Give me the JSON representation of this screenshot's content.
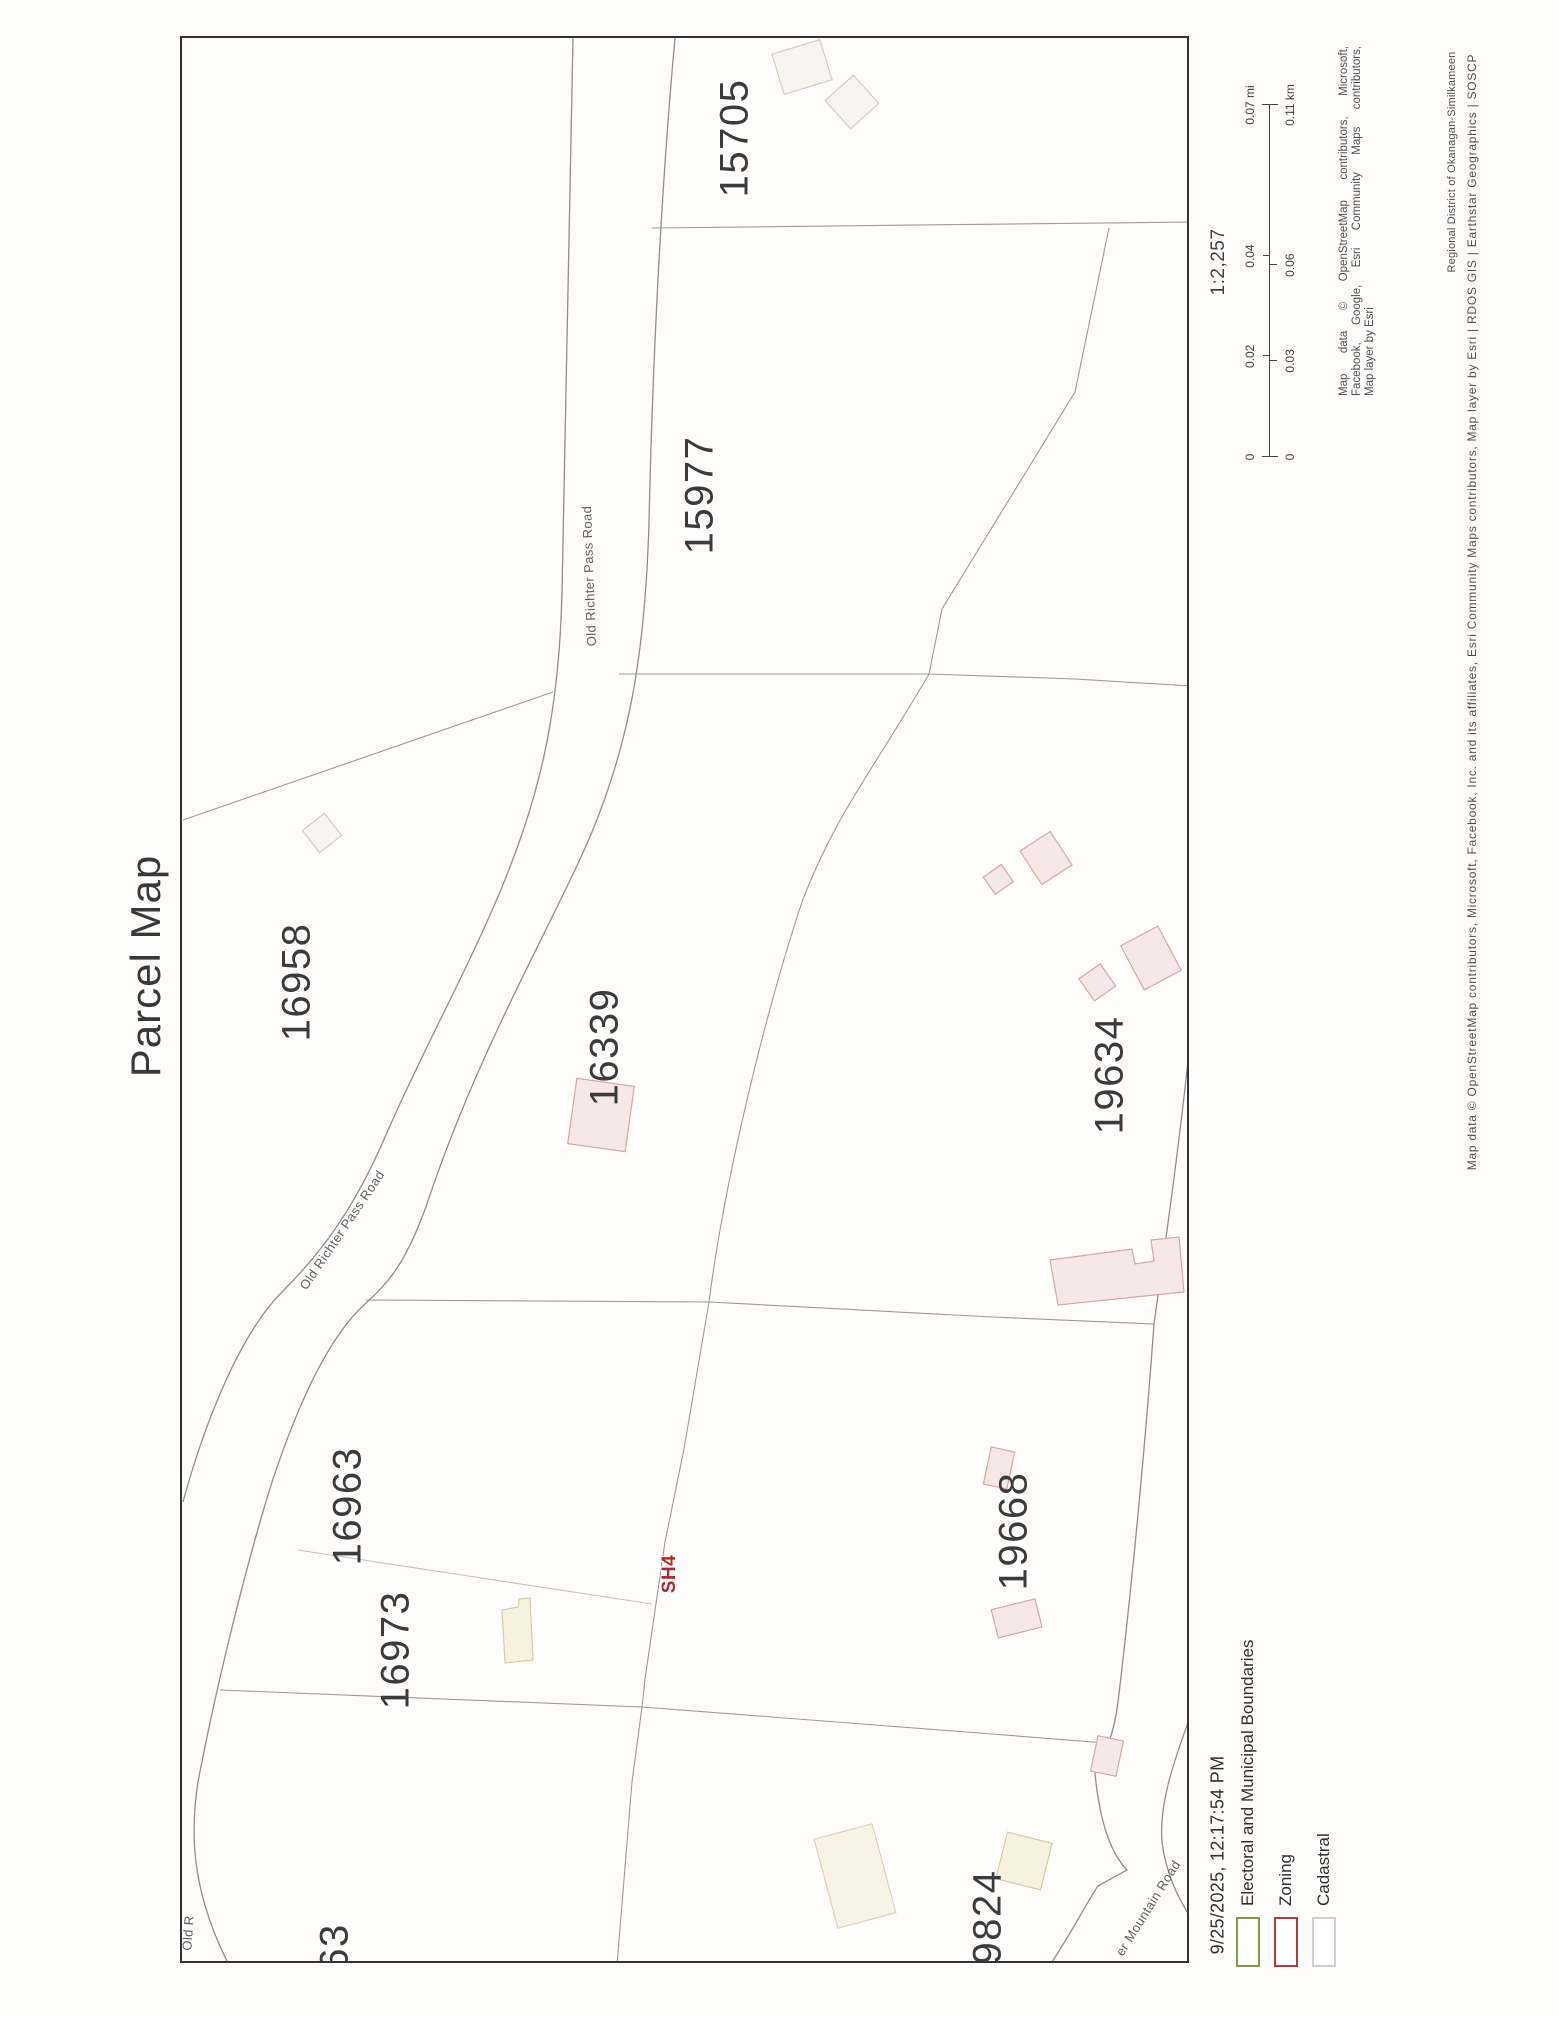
{
  "page_title": "Parcel Map",
  "map": {
    "parcels": [
      "15705",
      "15977",
      "16958",
      "16339",
      "19634",
      "16963",
      "16973",
      "19668",
      "9824",
      "63"
    ],
    "roads": {
      "old_richter_1": "Old Richter Pass Road",
      "old_richter_2": "Old Richter Pass Road",
      "mountain": "er Mountain Road",
      "corner_fragment": "Old R"
    },
    "zoning_label": "SH4",
    "line_colors": {
      "parcel_boundary": "#9a9a9a",
      "road": "#8e8e8e",
      "frame": "#333333"
    },
    "building_colors": {
      "pink_outline": "#d4a8a3",
      "pink_fill": "#f6e8e6",
      "beige_outline": "#d8cba6",
      "beige_fill": "#f7f1e2"
    }
  },
  "scale": {
    "ratio": "1:2,257",
    "mi": [
      "0",
      "0.02",
      "0.04",
      "0.07 mi"
    ],
    "km": [
      "0",
      "0.03",
      "0.06",
      "0.11 km"
    ]
  },
  "attribution": {
    "block_line1": "Map data © OpenStreetMap contributors, Microsoft,",
    "block_line2": "Facebook, Google, Esri Community Maps contributors,",
    "block_line3": "Map layer by Esri",
    "long_line": "Map data © OpenStreetMap contributors, Microsoft, Facebook, Inc. and its affiliates, Esri Community Maps contributors, Map layer by Esri | RDOS GIS | Earthstar Geographics | SOSCP",
    "region_line": "Regional District of Okanagan-Similkameen"
  },
  "footer": {
    "datetime": "9/25/2025, 12:17:54 PM"
  },
  "legend": {
    "items": [
      {
        "label": "Electoral and Municipal Boundaries",
        "color": "#7d9c44"
      },
      {
        "label": "Zoning",
        "color": "#b23b3e"
      },
      {
        "label": "Cadastral",
        "color": "#cfcfcf"
      }
    ]
  }
}
